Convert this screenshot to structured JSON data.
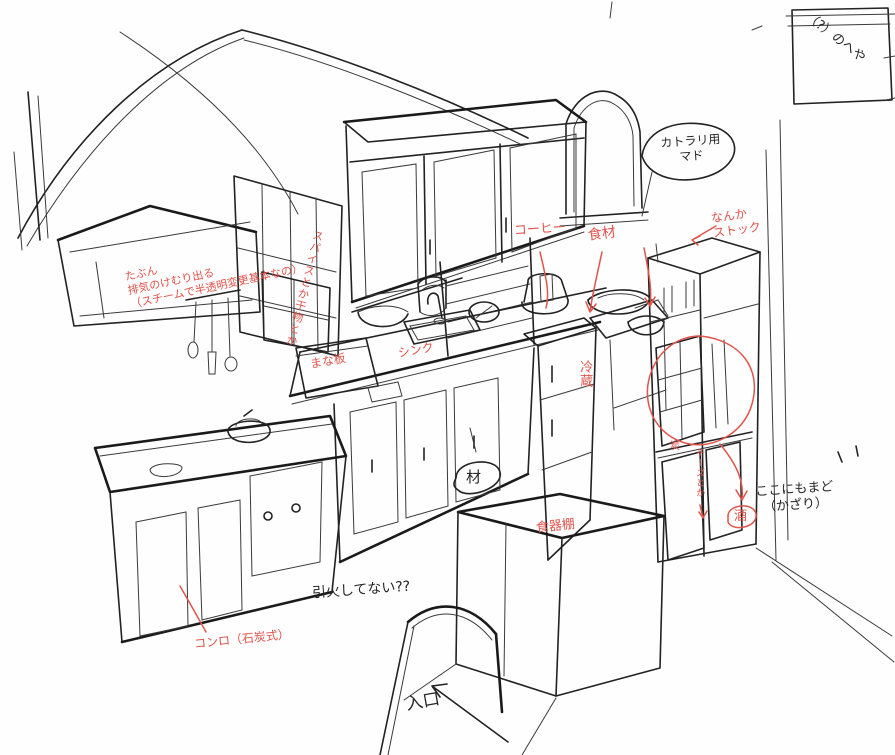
{
  "canvas": {
    "description": "Hand-drawn concept sketch of an L-shaped fantasy kitchen with Japanese annotations",
    "ink_color": "#222222",
    "annotation_red": "#e0544c",
    "background": "#fefefe"
  },
  "annotations": {
    "room_box": "（?）のへや",
    "cutlery_window": "カトラリ用\nマド",
    "stock": "なんか\nストック",
    "coffee": "コーヒー",
    "ingredients": "食材",
    "exhaust_note": "たぶん\n排気のけむり出る\n（スチームで半透明変更基本なの）",
    "spices": "スパイスとか干物とか",
    "cutting_board": "まな板",
    "sink": "シンク",
    "fridge": "冷蔵",
    "wood": "材",
    "dish_cabinet": "食器棚",
    "sake": "酒",
    "charcoal": "炭",
    "cheese": "チーズとか",
    "window_here": "ここにもまど\n　（かざり）",
    "stove": "コンロ（石炭式）",
    "ignite": "引火してない??",
    "entrance": "入口"
  }
}
